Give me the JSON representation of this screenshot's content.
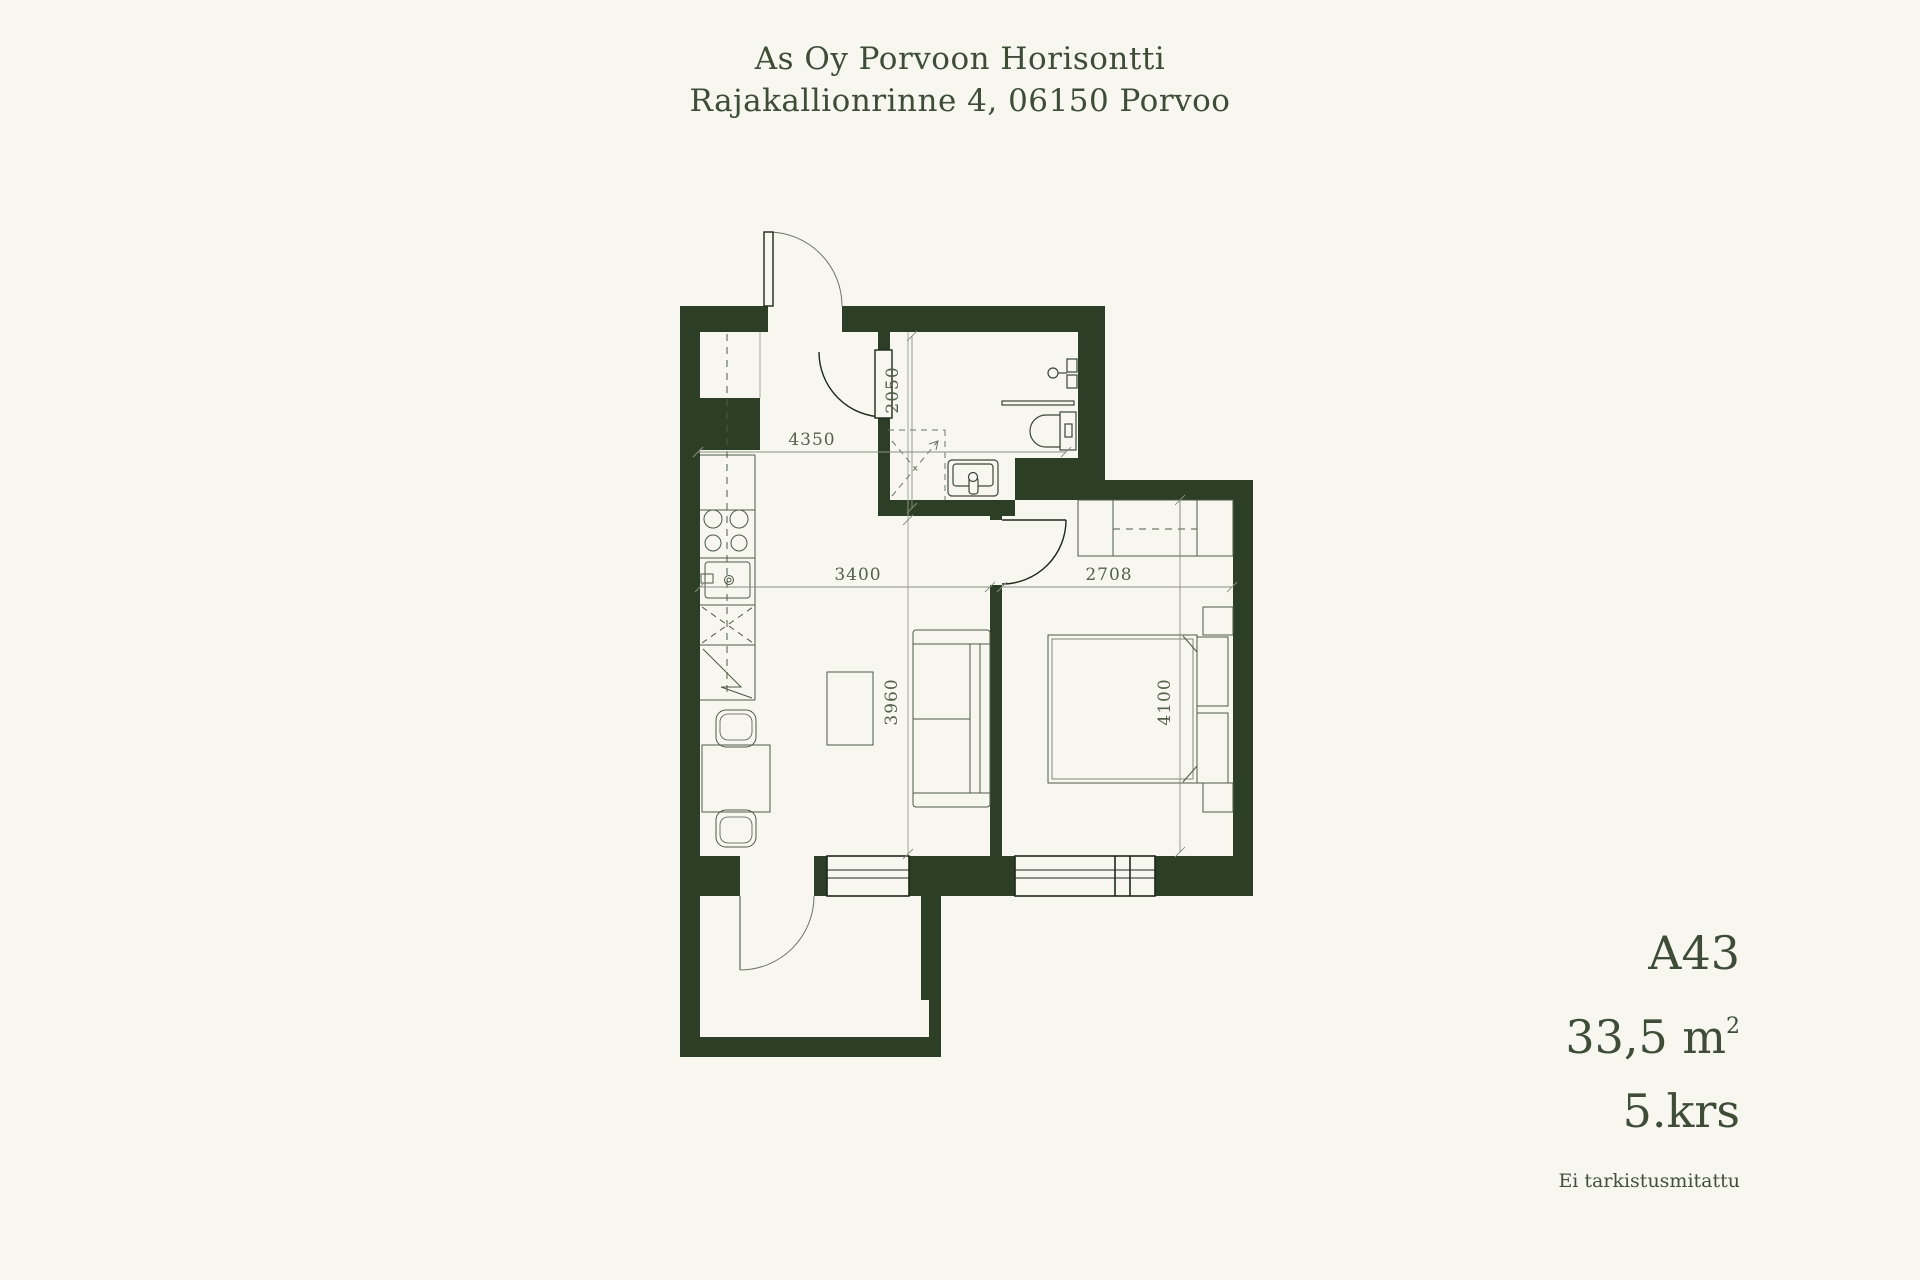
{
  "header": {
    "line1": "As Oy Porvoon Horisontti",
    "line2": "Rajakallionrinne 4, 06150 Porvoo"
  },
  "plan": {
    "dims": {
      "hall_width": "4350",
      "bathroom_depth": "2050",
      "living_width": "3400",
      "bedroom_width": "2708",
      "living_depth": "3960",
      "bedroom_depth": "4100"
    }
  },
  "info": {
    "apartment_id": "A43",
    "area_value": "33,5 m",
    "area_exponent": "2",
    "floor": "5.krs",
    "note": "Ei tarkistusmitattu"
  },
  "colors": {
    "background": "#f7f7f0",
    "wall": "#2c3f26",
    "title_text": "#3e4c38",
    "dimension_text": "#55604b",
    "drawing_line": "#4d5844",
    "thin_line": "#8a9180"
  }
}
